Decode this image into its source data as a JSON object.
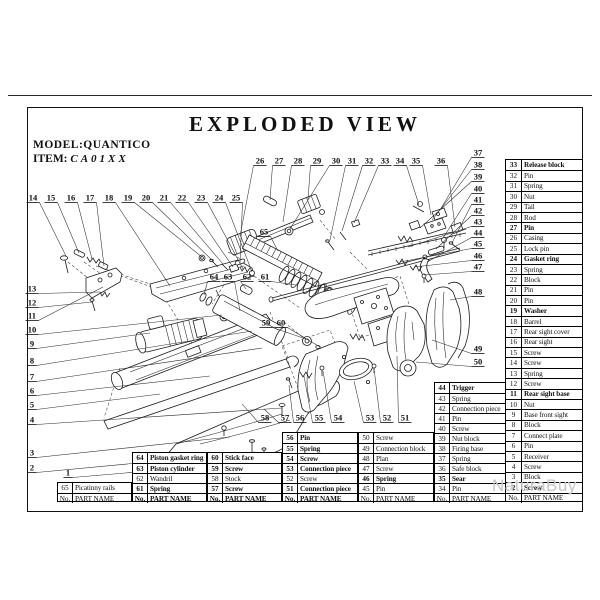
{
  "header": {
    "title": "EXPLODED VIEW",
    "model_label": "MODEL:",
    "model_value": "QUANTICO",
    "item_label": "ITEM:",
    "item_value": "CA01XX"
  },
  "watermark": "NaturaBuy",
  "footer_header": {
    "no": "No.",
    "name": "PART NAME"
  },
  "tables": [
    {
      "id": "t65",
      "x": 57,
      "y": 482,
      "w": 75,
      "noW": 15,
      "fb": 0,
      "rows": [
        {
          "no": "65",
          "name": "Picatinny rails"
        }
      ]
    },
    {
      "id": "t61",
      "x": 132,
      "y": 452,
      "w": 75,
      "noW": 15,
      "fb": 1,
      "rows": [
        {
          "no": "64",
          "name": "Piston gasket ring",
          "b": 1
        },
        {
          "no": "63",
          "name": "Piston cylinder",
          "b": 1
        },
        {
          "no": "62",
          "name": "Wandril"
        },
        {
          "no": "61",
          "name": "Spring",
          "b": 1
        }
      ]
    },
    {
      "id": "t57",
      "x": 207,
      "y": 452,
      "w": 75,
      "noW": 15,
      "fb": 1,
      "rows": [
        {
          "no": "60",
          "name": "Stick face",
          "b": 1
        },
        {
          "no": "59",
          "name": "Screw",
          "b": 1
        },
        {
          "no": "58",
          "name": "Stock"
        },
        {
          "no": "57",
          "name": "Screw",
          "b": 1
        }
      ]
    },
    {
      "id": "t51",
      "x": 282,
      "y": 432,
      "w": 76,
      "noW": 15,
      "fb": 1,
      "rows": [
        {
          "no": "56",
          "name": "Pin",
          "b": 1
        },
        {
          "no": "55",
          "name": "Spring",
          "b": 1
        },
        {
          "no": "54",
          "name": "Screw",
          "b": 1
        },
        {
          "no": "53",
          "name": "Connection piece",
          "b": 1
        },
        {
          "no": "52",
          "name": "Screw"
        },
        {
          "no": "51",
          "name": "Connection piece",
          "b": 1
        }
      ]
    },
    {
      "id": "t45",
      "x": 358,
      "y": 432,
      "w": 76,
      "noW": 15,
      "fb": 0,
      "rows": [
        {
          "no": "50",
          "name": "Screw"
        },
        {
          "no": "49",
          "name": "Connection block"
        },
        {
          "no": "48",
          "name": "Plan"
        },
        {
          "no": "47",
          "name": "Screw"
        },
        {
          "no": "46",
          "name": "Spring",
          "b": 1
        },
        {
          "no": "45",
          "name": "Pin"
        }
      ]
    },
    {
      "id": "t34",
      "x": 434,
      "y": 382,
      "w": 72,
      "noW": 15,
      "fb": 0,
      "rows": [
        {
          "no": "44",
          "name": "Trigger",
          "b": 1
        },
        {
          "no": "43",
          "name": "Spring"
        },
        {
          "no": "42",
          "name": "Connection piece"
        },
        {
          "no": "41",
          "name": "Pin"
        },
        {
          "no": "40",
          "name": "Screw"
        },
        {
          "no": "39",
          "name": "Nut block"
        },
        {
          "no": "38",
          "name": "Firing base"
        },
        {
          "no": "37",
          "name": "Spring"
        },
        {
          "no": "36",
          "name": "Safe block"
        },
        {
          "no": "35",
          "name": "Sear",
          "b": 1
        },
        {
          "no": "34",
          "name": "Pin"
        }
      ]
    },
    {
      "id": "t02",
      "x": 505,
      "y": 159,
      "w": 78,
      "noW": 16,
      "fb": 0,
      "rows": [
        {
          "no": "33",
          "name": "Release block",
          "b": 1
        },
        {
          "no": "32",
          "name": "Pin"
        },
        {
          "no": "31",
          "name": "Spring"
        },
        {
          "no": "30",
          "name": "Nut"
        },
        {
          "no": "29",
          "name": "Tail"
        },
        {
          "no": "28",
          "name": "Rod"
        },
        {
          "no": "27",
          "name": "Pin",
          "b": 1
        },
        {
          "no": "26",
          "name": "Casing"
        },
        {
          "no": "25",
          "name": "Lock pin"
        },
        {
          "no": "24",
          "name": "Gasket ring",
          "b": 1
        },
        {
          "no": "23",
          "name": "Spring"
        },
        {
          "no": "22",
          "name": "Block"
        },
        {
          "no": "21",
          "name": "Pin"
        },
        {
          "no": "20",
          "name": "Pin"
        },
        {
          "no": "19",
          "name": "Washer",
          "b": 1
        },
        {
          "no": "18",
          "name": "Barrel"
        },
        {
          "no": "17",
          "name": "Rear sight cover"
        },
        {
          "no": "16",
          "name": "Rear sight"
        },
        {
          "no": "15",
          "name": "Screw"
        },
        {
          "no": "14",
          "name": "Screw"
        },
        {
          "no": "13",
          "name": "Spring"
        },
        {
          "no": "12",
          "name": "Screw"
        },
        {
          "no": "11",
          "name": "Rear sight base",
          "b": 1
        },
        {
          "no": "10",
          "name": "Nut"
        },
        {
          "no": "9",
          "name": "Base front sight"
        },
        {
          "no": "8",
          "name": "Block"
        },
        {
          "no": "7",
          "name": "Connect plate"
        },
        {
          "no": "6",
          "name": "Pin"
        },
        {
          "no": "5",
          "name": "Receiver"
        },
        {
          "no": "4",
          "name": "Screw"
        },
        {
          "no": "3",
          "name": "Block"
        },
        {
          "no": "2",
          "name": "Screw",
          "b": 1
        }
      ]
    }
  ],
  "callouts": [
    {
      "n": "1",
      "x": 68,
      "y": 472,
      "tx": 300,
      "ty": 458
    },
    {
      "n": "2",
      "x": 32,
      "y": 467,
      "tx": 255,
      "ty": 452
    },
    {
      "n": "3",
      "x": 32,
      "y": 452,
      "tx": 230,
      "ty": 437
    },
    {
      "n": "4",
      "x": 32,
      "y": 419,
      "tx": 282,
      "ty": 408
    },
    {
      "n": "5",
      "x": 32,
      "y": 404,
      "tx": 160,
      "ty": 394
    },
    {
      "n": "6",
      "x": 32,
      "y": 390,
      "tx": 210,
      "ty": 376
    },
    {
      "n": "7",
      "x": 32,
      "y": 376,
      "tx": 262,
      "ty": 348
    },
    {
      "n": "8",
      "x": 32,
      "y": 360,
      "tx": 252,
      "ty": 331
    },
    {
      "n": "9",
      "x": 32,
      "y": 343,
      "tx": 150,
      "ty": 333
    },
    {
      "n": "10",
      "x": 32,
      "y": 329,
      "tx": 222,
      "ty": 315
    },
    {
      "n": "11",
      "x": 32,
      "y": 315,
      "tx": 103,
      "ty": 287
    },
    {
      "n": "12",
      "x": 32,
      "y": 302,
      "tx": 92,
      "ty": 302
    },
    {
      "n": "13",
      "x": 32,
      "y": 288,
      "tx": 100,
      "ty": 292
    },
    {
      "n": "14",
      "x": 33,
      "y": 197,
      "tx": 66,
      "ty": 256
    },
    {
      "n": "15",
      "x": 51,
      "y": 197,
      "tx": 79,
      "ty": 253
    },
    {
      "n": "16",
      "x": 71,
      "y": 197,
      "tx": 92,
      "ty": 259
    },
    {
      "n": "17",
      "x": 90,
      "y": 197,
      "tx": 104,
      "ty": 266
    },
    {
      "n": "18",
      "x": 109,
      "y": 197,
      "tx": 170,
      "ty": 286
    },
    {
      "n": "19",
      "x": 128,
      "y": 197,
      "tx": 202,
      "ty": 257
    },
    {
      "n": "20",
      "x": 146,
      "y": 197,
      "tx": 213,
      "ty": 261
    },
    {
      "n": "21",
      "x": 164,
      "y": 197,
      "tx": 223,
      "ty": 264
    },
    {
      "n": "22",
      "x": 182,
      "y": 197,
      "tx": 233,
      "ty": 267
    },
    {
      "n": "23",
      "x": 201,
      "y": 197,
      "tx": 243,
      "ty": 269
    },
    {
      "n": "24",
      "x": 219,
      "y": 197,
      "tx": 252,
      "ty": 272
    },
    {
      "n": "25",
      "x": 236,
      "y": 197,
      "tx": 240,
      "ty": 263
    },
    {
      "n": "26",
      "x": 260,
      "y": 160,
      "tx": 240,
      "ty": 236
    },
    {
      "n": "27",
      "x": 279,
      "y": 160,
      "tx": 270,
      "ty": 200
    },
    {
      "n": "28",
      "x": 298,
      "y": 160,
      "tx": 283,
      "ty": 222
    },
    {
      "n": "29",
      "x": 317,
      "y": 160,
      "tx": 308,
      "ty": 199
    },
    {
      "n": "30",
      "x": 336,
      "y": 160,
      "tx": 290,
      "ty": 229
    },
    {
      "n": "31",
      "x": 352,
      "y": 160,
      "tx": 330,
      "ty": 240
    },
    {
      "n": "32",
      "x": 369,
      "y": 160,
      "tx": 342,
      "ty": 231
    },
    {
      "n": "33",
      "x": 385,
      "y": 160,
      "tx": 354,
      "ty": 223
    },
    {
      "n": "34",
      "x": 400,
      "y": 160,
      "tx": 419,
      "ty": 205
    },
    {
      "n": "35",
      "x": 416,
      "y": 160,
      "tx": 431,
      "ty": 215
    },
    {
      "n": "36",
      "x": 441,
      "y": 160,
      "tx": 455,
      "ty": 227
    },
    {
      "n": "37",
      "x": 478,
      "y": 152,
      "tx": 440,
      "ty": 210
    },
    {
      "n": "38",
      "x": 478,
      "y": 164,
      "tx": 432,
      "ty": 220
    },
    {
      "n": "39",
      "x": 478,
      "y": 176,
      "tx": 420,
      "ty": 228
    },
    {
      "n": "40",
      "x": 478,
      "y": 188,
      "tx": 443,
      "ty": 238
    },
    {
      "n": "41",
      "x": 478,
      "y": 199,
      "tx": 452,
      "ty": 243
    },
    {
      "n": "42",
      "x": 478,
      "y": 210,
      "tx": 436,
      "ty": 249
    },
    {
      "n": "43",
      "x": 478,
      "y": 221,
      "tx": 408,
      "ty": 247
    },
    {
      "n": "44",
      "x": 478,
      "y": 232,
      "tx": 427,
      "ty": 262
    },
    {
      "n": "45",
      "x": 478,
      "y": 243,
      "tx": 400,
      "ty": 262
    },
    {
      "n": "46",
      "x": 478,
      "y": 255,
      "tx": 414,
      "ty": 267
    },
    {
      "n": "47",
      "x": 478,
      "y": 266,
      "tx": 424,
      "ty": 275
    },
    {
      "n": "48",
      "x": 478,
      "y": 291,
      "tx": 450,
      "ty": 300
    },
    {
      "n": "49",
      "x": 478,
      "y": 348,
      "tx": 432,
      "ty": 340
    },
    {
      "n": "50",
      "x": 478,
      "y": 361,
      "tx": 416,
      "ty": 362
    },
    {
      "n": "51",
      "x": 405,
      "y": 417,
      "tx": 397,
      "ty": 356
    },
    {
      "n": "52",
      "x": 387,
      "y": 417,
      "tx": 374,
      "ty": 368
    },
    {
      "n": "53",
      "x": 370,
      "y": 417,
      "tx": 354,
      "ty": 381
    },
    {
      "n": "54",
      "x": 338,
      "y": 417,
      "tx": 323,
      "ty": 371
    },
    {
      "n": "55",
      "x": 319,
      "y": 417,
      "tx": 304,
      "ty": 376
    },
    {
      "n": "56",
      "x": 300,
      "y": 417,
      "tx": 289,
      "ty": 385
    },
    {
      "n": "57",
      "x": 285,
      "y": 417,
      "tx": 264,
      "ty": 409
    },
    {
      "n": "58",
      "x": 265,
      "y": 417,
      "tx": 242,
      "ty": 404
    },
    {
      "n": "59",
      "x": 266,
      "y": 322,
      "tx": 306,
      "ty": 339
    },
    {
      "n": "60",
      "x": 281,
      "y": 322,
      "tx": 320,
      "ty": 347
    },
    {
      "n": "61",
      "x": 265,
      "y": 276,
      "tx": 296,
      "ty": 285
    },
    {
      "n": "62",
      "x": 247,
      "y": 276,
      "tx": 246,
      "ty": 289
    },
    {
      "n": "63",
      "x": 228,
      "y": 276,
      "tx": 240,
      "ty": 311
    },
    {
      "n": "64",
      "x": 214,
      "y": 276,
      "tx": 204,
      "ty": 295
    },
    {
      "n": "65",
      "x": 264,
      "y": 231,
      "tx": 278,
      "ty": 251
    }
  ]
}
